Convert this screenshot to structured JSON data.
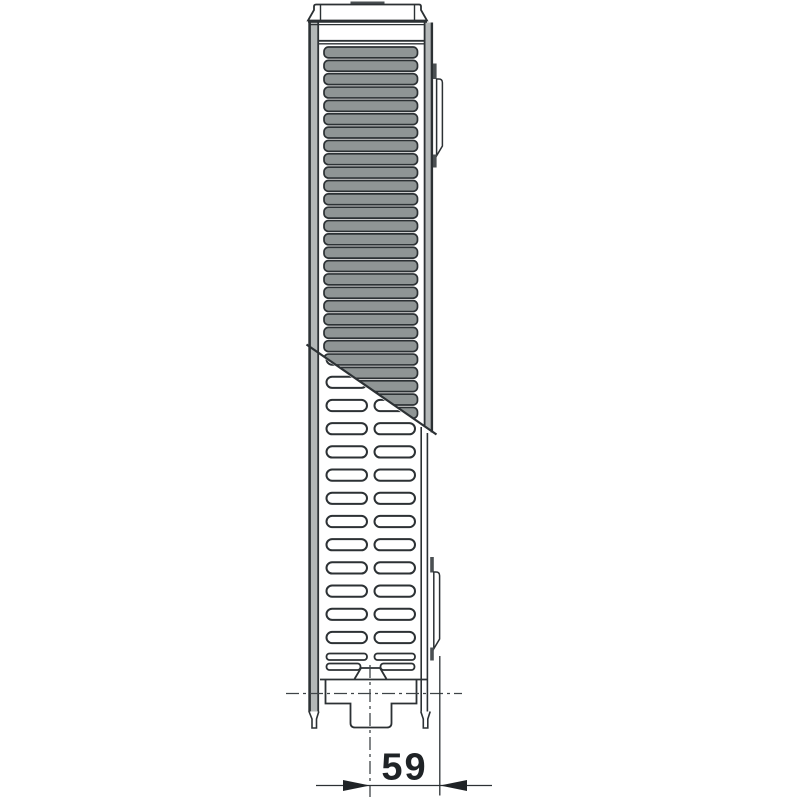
{
  "dimension": {
    "value": "59"
  },
  "colors": {
    "line": "#2c3134",
    "fin_fill": "#8f9595",
    "strip_fill": "#b3b7b7",
    "dark_fill": "#4a4f52",
    "centerline": "#3f4447",
    "background": "#ffffff",
    "dimension_text": "#1f2326"
  },
  "fins": {
    "count": 29
  },
  "slots": {
    "rows": 13,
    "columns": 2,
    "thin_slat_rows": 2
  }
}
